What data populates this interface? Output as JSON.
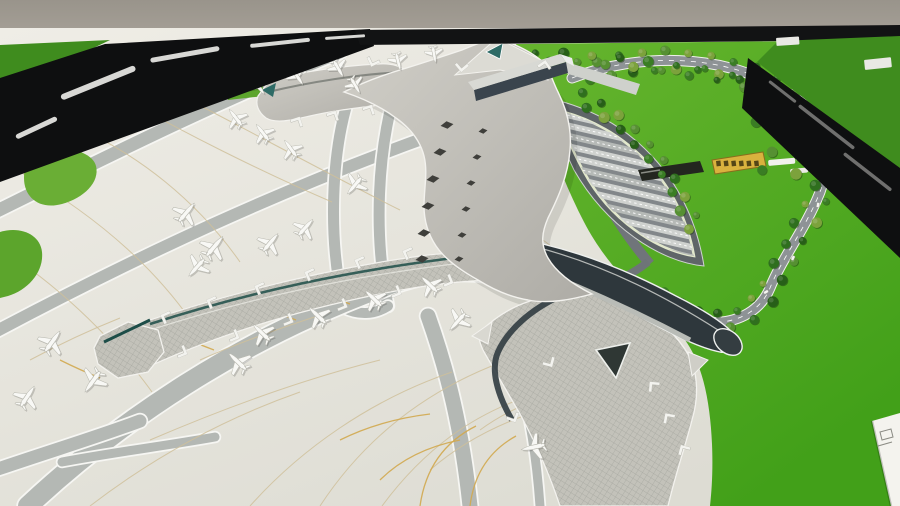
{
  "scene": {
    "type": "photograph",
    "subject": "architectural scale model of a starfish-shaped airport terminal on exhibition tables",
    "tables": "three black-framed model tables with green felt, gray wall behind"
  },
  "palette": {
    "wall_top": "#99948b",
    "wall_bot": "#aaa49b",
    "frame_black": "#0e0f10",
    "frame_streak": "#e9e9e6",
    "neighbor_felt": "#3f8c1e",
    "lawn_light": "#63b32c",
    "lawn_dark": "#46a01c",
    "airside_light": "#edebe4",
    "airside_dark": "#dedcd4",
    "taxiway": "#b4b8b4",
    "taxiway_edge": "#f6f6f3",
    "tan_line": "#cfc09a",
    "yellow_line": "#d2a94f",
    "roof_light": "#cdcbc4",
    "roof_dark": "#b2b0aa",
    "roof_rim": "#f3f2ee",
    "glass_dark": "#2e383d",
    "teal": "#2e6b66",
    "teal_ridge": "#1d4d48",
    "skylight": "#3f3f3b",
    "parking_base": "#5f6568",
    "parking_inner": "#82878a",
    "parking_stripe_a": "#cfd2cf",
    "parking_stripe_b": "#b6bab7",
    "parking_rim": "#e2e8cc",
    "road": "#8e9396",
    "tree_colors": [
      "#275f18",
      "#2f6f1e",
      "#3a7d24",
      "#569032",
      "#7ca23c"
    ],
    "plane_fill": "#f8f8f5",
    "plane_edge": "#b9b9b0",
    "tower_white": "#f4f4f0",
    "sign_fill": "#d9b23e",
    "sign_glyph": "#453a12",
    "plaque_white": "#f4f3ee"
  },
  "sign": {
    "glyph_count": 6,
    "x": 716,
    "y": 161,
    "step": 7.6,
    "rot": -7
  },
  "grass_islands": [
    "M148,44 L210,40 L214,56 L176,60 L180,72 L150,76 Z",
    "M222,52 L266,48 L270,64 L244,66 L248,84 L262,82 L264,96 L228,100 Z",
    "M298,46 L334,42 L336,52 L300,57 Z",
    "M76,100 C84,88 120,86 130,98 C136,108 128,124 110,130 C92,136 72,122 76,100 Z",
    "M36,152 C60,144 92,150 96,166 C100,182 84,198 62,204 C40,210 24,198 24,178 C24,164 28,156 36,152 Z",
    "M0,232 C20,226 40,234 42,252 C44,272 28,290 8,296 L0,298 Z",
    "M0,136 C10,132 20,136 20,148 C20,160 10,168 0,170 Z"
  ],
  "taxiways": [
    {
      "d": "M-5,212 C100,160 220,100 340,52",
      "w": 13
    },
    {
      "d": "M-5,332 C140,255 280,190 430,136",
      "w": 12
    },
    {
      "d": "M352,88 C330,150 328,240 344,308",
      "w": 11
    },
    {
      "d": "M398,82 C376,150 374,238 388,306",
      "w": 11
    },
    {
      "d": "M352,88 C366,79 384,77 398,82",
      "w": 10
    },
    {
      "d": "M344,308 C358,315 374,315 388,306",
      "w": 10
    },
    {
      "d": "M28,506 C120,420 240,340 380,288 C420,272 456,268 486,272",
      "w": 20
    },
    {
      "d": "M470,506 C462,430 448,372 428,316",
      "w": 15
    },
    {
      "d": "M-5,470 C60,448 100,436 140,421",
      "w": 13
    },
    {
      "d": "M62,462 C115,452 165,446 215,437",
      "w": 9
    },
    {
      "d": "M540,506 C536,450 528,400 512,356",
      "w": 9
    }
  ],
  "tan_lines": [
    "M60,120 C140,152 200,205 240,262",
    "M20,172 C90,212 150,262 192,322",
    "M112,92 C182,132 262,172 332,202",
    "M6,252 C66,292 116,342 152,392",
    "M150,80 C230,120 320,170 400,210",
    "M250,506 C300,450 370,400 452,372",
    "M320,506 C362,442 422,392 502,362",
    "M382,506 C422,452 472,412 542,392",
    "M150,440 C220,410 300,380 380,360",
    "M90,506 C150,460 220,420 300,392",
    "M440,250 C480,262 520,282 550,306",
    "M470,200 C510,216 548,240 576,268",
    "M200,360 C240,342 286,326 330,312",
    "M30,360 C60,344 90,330 120,318",
    "M480,430 C510,408 550,392 590,384",
    "M430,470 C460,444 500,422 548,408"
  ],
  "yellow_lines": [
    "M252,300 q22,12 44,20",
    "M306,284 q22,12 44,20",
    "M360,268 q22,12 44,20",
    "M170,330 q22,12 44,20",
    "M420,506 q8,-56 56,-80",
    "M470,506 q6,-48 46,-70",
    "M380,480 q30,-30 80,-40",
    "M340,440 q40,-20 90,-26",
    "M60,360 q20,10 40,18",
    "M500,330 q16,10 30,20"
  ],
  "planes": [
    {
      "x": 186,
      "y": 213,
      "r": 40,
      "s": 1.0
    },
    {
      "x": 214,
      "y": 247,
      "r": 40,
      "s": 1.05
    },
    {
      "x": 197,
      "y": 267,
      "r": 222,
      "s": 0.95
    },
    {
      "x": 270,
      "y": 243,
      "r": 40,
      "s": 0.95
    },
    {
      "x": 305,
      "y": 228,
      "r": 42,
      "s": 0.9
    },
    {
      "x": 355,
      "y": 185,
      "r": 220,
      "s": 0.9
    },
    {
      "x": 236,
      "y": 118,
      "r": -38,
      "s": 0.85
    },
    {
      "x": 263,
      "y": 133,
      "r": -38,
      "s": 0.85
    },
    {
      "x": 291,
      "y": 149,
      "r": -36,
      "s": 0.85
    },
    {
      "x": 258,
      "y": 86,
      "r": 142,
      "s": 0.8
    },
    {
      "x": 297,
      "y": 76,
      "r": 146,
      "s": 0.8
    },
    {
      "x": 338,
      "y": 68,
      "r": 150,
      "s": 0.78
    },
    {
      "x": 355,
      "y": 85,
      "r": 150,
      "s": 0.75
    },
    {
      "x": 398,
      "y": 61,
      "r": 166,
      "s": 0.74
    },
    {
      "x": 434,
      "y": 54,
      "r": 170,
      "s": 0.7
    },
    {
      "x": 262,
      "y": 333,
      "r": -46,
      "s": 0.95
    },
    {
      "x": 318,
      "y": 316,
      "r": -46,
      "s": 0.95
    },
    {
      "x": 374,
      "y": 299,
      "r": -46,
      "s": 0.92
    },
    {
      "x": 430,
      "y": 285,
      "r": -46,
      "s": 0.9
    },
    {
      "x": 238,
      "y": 362,
      "r": -46,
      "s": 1.0
    },
    {
      "x": 52,
      "y": 342,
      "r": 36,
      "s": 1.05
    },
    {
      "x": 93,
      "y": 381,
      "r": 216,
      "s": 1.05
    },
    {
      "x": 27,
      "y": 397,
      "r": 34,
      "s": 1.0
    },
    {
      "x": 458,
      "y": 321,
      "r": 222,
      "s": 0.95
    },
    {
      "x": 534,
      "y": 447,
      "r": 258,
      "s": 1.0
    }
  ],
  "bridges": [
    {
      "x": 168,
      "y": 318,
      "r": -24
    },
    {
      "x": 214,
      "y": 303,
      "r": -24
    },
    {
      "x": 262,
      "y": 289,
      "r": -24
    },
    {
      "x": 312,
      "y": 275,
      "r": -24
    },
    {
      "x": 362,
      "y": 263,
      "r": -24
    },
    {
      "x": 410,
      "y": 254,
      "r": -24
    },
    {
      "x": 180,
      "y": 351,
      "r": 158
    },
    {
      "x": 232,
      "y": 335,
      "r": 158
    },
    {
      "x": 286,
      "y": 319,
      "r": 158
    },
    {
      "x": 340,
      "y": 304,
      "r": 158
    },
    {
      "x": 394,
      "y": 291,
      "r": 158
    },
    {
      "x": 446,
      "y": 280,
      "r": 158
    },
    {
      "x": 548,
      "y": 360,
      "r": 195
    },
    {
      "x": 512,
      "y": 415,
      "r": 200
    },
    {
      "x": 655,
      "y": 388,
      "r": 5
    },
    {
      "x": 670,
      "y": 420,
      "r": 10
    },
    {
      "x": 685,
      "y": 452,
      "r": 15
    },
    {
      "x": 300,
      "y": 69,
      "r": -115
    },
    {
      "x": 338,
      "y": 63,
      "r": -115
    },
    {
      "x": 374,
      "y": 59,
      "r": -115
    },
    {
      "x": 296,
      "y": 124,
      "r": 72
    },
    {
      "x": 332,
      "y": 118,
      "r": 72
    },
    {
      "x": 368,
      "y": 112,
      "r": 72
    },
    {
      "x": 462,
      "y": 64,
      "r": -130
    },
    {
      "x": 544,
      "y": 68,
      "r": 55
    }
  ],
  "diamonds": {
    "left": [
      {
        "x": 447,
        "y": 125
      },
      {
        "x": 440,
        "y": 152
      },
      {
        "x": 433,
        "y": 179
      },
      {
        "x": 428,
        "y": 206
      },
      {
        "x": 424,
        "y": 233
      },
      {
        "x": 422,
        "y": 259
      }
    ],
    "right": [
      {
        "x": 483,
        "y": 131
      },
      {
        "x": 477,
        "y": 157
      },
      {
        "x": 471,
        "y": 183
      },
      {
        "x": 466,
        "y": 209
      },
      {
        "x": 462,
        "y": 235
      },
      {
        "x": 459,
        "y": 259
      }
    ],
    "w_left": 13,
    "h_left": 7.5,
    "w_right": 9,
    "h_right": 5.5
  },
  "parking": {
    "stripes": 14,
    "x0": 546,
    "y0": 107,
    "dx": 4.2,
    "dy": 11.3,
    "len": 150,
    "h": 6.2,
    "rot": 13
  },
  "tree_paths": [
    {
      "d": "M572,78 C640,52 722,55 775,86 C818,112 835,152 820,192 C806,228 782,258 770,288 C760,312 735,325 705,322 C685,320 668,308 655,292",
      "n": 52,
      "off": 8
    },
    {
      "d": "M575,96 C630,120 672,168 696,232",
      "n": 18,
      "off": 5
    },
    {
      "d": "M528,56 C600,58 680,66 752,84",
      "n": 16,
      "off": 4
    }
  ],
  "extra_trees": [
    {
      "x": 764,
      "y": 96
    },
    {
      "x": 774,
      "y": 110
    },
    {
      "x": 756,
      "y": 122
    },
    {
      "x": 786,
      "y": 142
    },
    {
      "x": 818,
      "y": 142
    },
    {
      "x": 828,
      "y": 120
    },
    {
      "x": 772,
      "y": 152
    },
    {
      "x": 812,
      "y": 166
    },
    {
      "x": 796,
      "y": 174
    },
    {
      "x": 762,
      "y": 170
    },
    {
      "x": 840,
      "y": 100
    }
  ],
  "vehicles": [
    {
      "x": 788,
      "y": 110,
      "r": 40
    },
    {
      "x": 822,
      "y": 150,
      "r": 75
    },
    {
      "x": 818,
      "y": 205,
      "r": 100
    },
    {
      "x": 793,
      "y": 258,
      "r": 115
    },
    {
      "x": 766,
      "y": 292,
      "r": 150
    },
    {
      "x": 636,
      "y": 282,
      "r": 25
    },
    {
      "x": 612,
      "y": 272,
      "r": 25
    }
  ],
  "frame_streaks_tl": [
    {
      "x": 150,
      "y": 58,
      "w": 70,
      "h": 5,
      "r": -10
    },
    {
      "x": 60,
      "y": 95,
      "w": 80,
      "h": 6,
      "r": -22
    },
    {
      "x": 15,
      "y": 135,
      "w": 45,
      "h": 5,
      "r": -25
    },
    {
      "x": 250,
      "y": 44,
      "w": 60,
      "h": 4,
      "r": -6
    },
    {
      "x": 325,
      "y": 37,
      "w": 40,
      "h": 3,
      "r": -4
    }
  ],
  "frame_streaks_r": [
    {
      "x": 770,
      "y": 80,
      "w": 34,
      "h": 3,
      "r": 38
    },
    {
      "x": 800,
      "y": 104,
      "w": 70,
      "h": 3.5,
      "r": 38
    },
    {
      "x": 845,
      "y": 152,
      "w": 60,
      "h": 3.5,
      "r": 38
    }
  ]
}
